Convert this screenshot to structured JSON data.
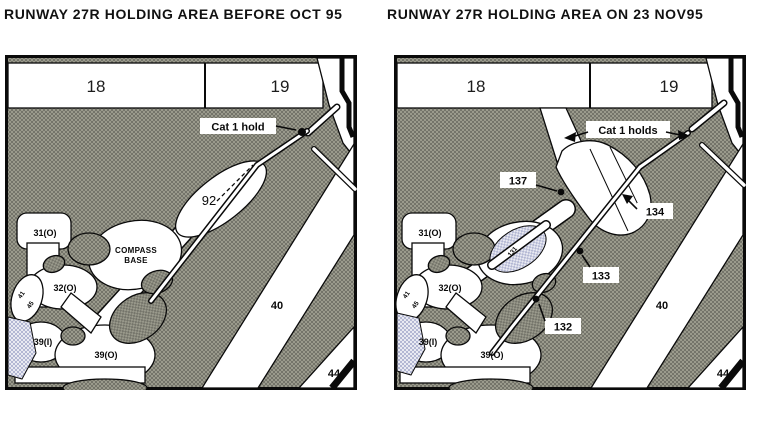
{
  "colors": {
    "ink": "#0a0a0a",
    "paper": "#ffffff",
    "pavement_gray_dark": "#74746a",
    "pavement_gray_light": "#9a9a8c",
    "work_area_lavender_dark": "#b3b7d3",
    "work_area_lavender_light": "#e9eaf2"
  },
  "titles": {
    "before": "RUNWAY 27R HOLDING AREA BEFORE OCT 95",
    "after": "RUNWAY 27R HOLDING AREA ON 23 NOV95"
  },
  "before_map": {
    "runway_blocks": {
      "block_18": "18",
      "block_19": "19"
    },
    "hold_label": "Cat 1 hold",
    "holding_area_label": "92",
    "compass_base": {
      "line1": "COMPASS",
      "line2": "BASE"
    },
    "stands": {
      "s31": "31(O)",
      "s32": "32(O)",
      "s39i": "39(I)",
      "s39o": "39(O)",
      "small_rotated_1": "41",
      "small_rotated_2": "45"
    },
    "taxiways": {
      "t40": "40",
      "t44": "44"
    }
  },
  "after_map": {
    "runway_blocks": {
      "block_18": "18",
      "block_19": "19"
    },
    "hold_label": "Cat 1 holds",
    "hold_points": {
      "h137": "137",
      "h134": "134",
      "h133": "133",
      "h132": "132"
    },
    "work_area_label": "131",
    "stands": {
      "s31": "31(O)",
      "s32": "32(O)",
      "s39i": "39(I)",
      "s39o": "39(O)",
      "small_rotated_1": "41",
      "small_rotated_2": "45"
    },
    "taxiways": {
      "t40": "40",
      "t44": "44"
    }
  }
}
